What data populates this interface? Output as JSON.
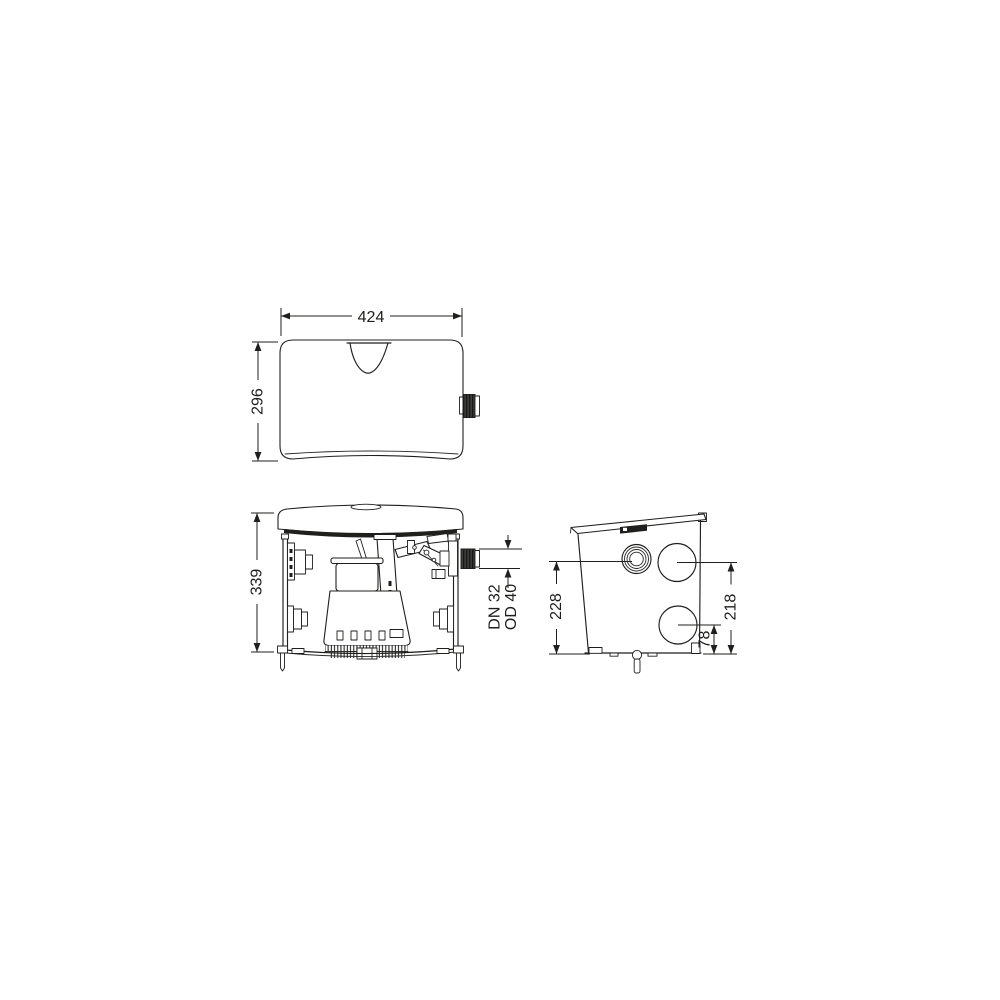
{
  "drawing": {
    "kind": "technical-dimension-drawing",
    "colors": {
      "ink": "#1f1f1e",
      "background": "#ffffff",
      "dark_fill": "#1f1f1e"
    },
    "views": {
      "top": {
        "dims": {
          "width": "424",
          "depth": "296"
        }
      },
      "front": {
        "dims": {
          "height": "339"
        },
        "outlet": {
          "line1": "DN 32",
          "line2": "OD 40"
        }
      },
      "side": {
        "dims": {
          "cap_center_height": "228",
          "upper_inlet_center_height": "218",
          "lower_inlet_center_height": "78"
        }
      }
    }
  }
}
